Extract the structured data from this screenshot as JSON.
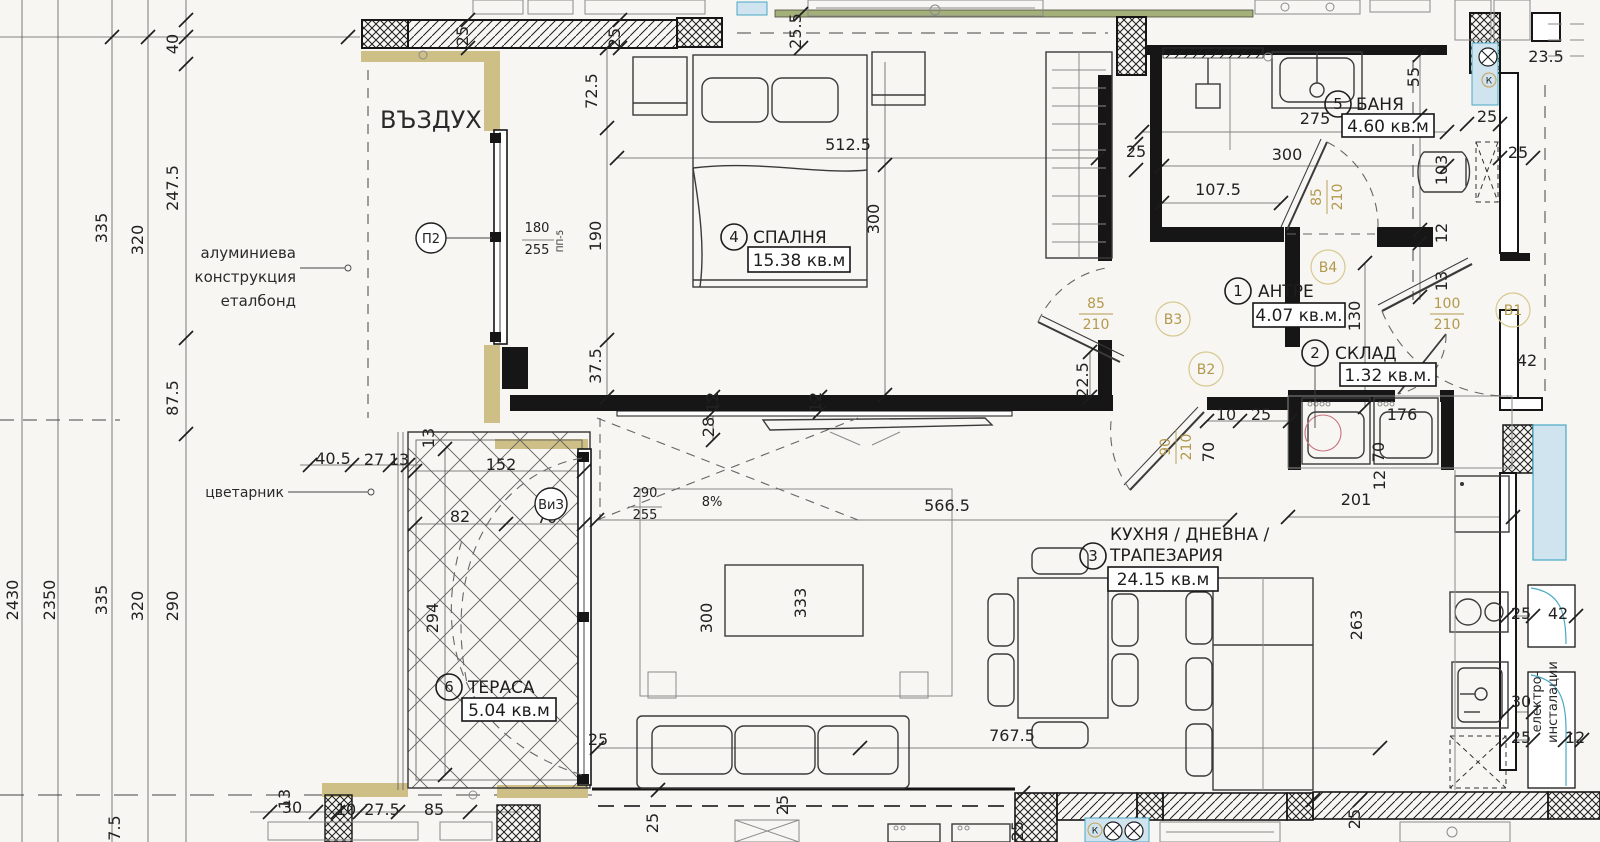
{
  "drawing_title": "апартамент — разпределение (floor plan)",
  "units_label": "кв.м",
  "colors": {
    "paper": "#f7f6f2",
    "ink": "#1d1d1d",
    "insulation_olive": "#cdbf85",
    "facade_green": "#a4b07a",
    "shaft_cyan_fill": "#cfe4ef",
    "shaft_cyan_stroke": "#49a8c4",
    "door_tag_olive": "#b3984d",
    "accent_red": "#c9707c"
  },
  "rooms": [
    {
      "num": "1",
      "name": "АНТРЕ",
      "area": "4.07 кв.м."
    },
    {
      "num": "2",
      "name": "СКЛАД",
      "area": "1.32 кв.м."
    },
    {
      "num": "3",
      "name": "КУХНЯ / ДНЕВНА /",
      "name2": "ТРАПЕЗАРИЯ",
      "area": "24.15 кв.м"
    },
    {
      "num": "4",
      "name": "СПАЛНЯ",
      "area": "15.38 кв.м"
    },
    {
      "num": "5",
      "name": "БАНЯ",
      "area": "4.60 кв.м"
    },
    {
      "num": "6",
      "name": "ТЕРАСА",
      "area": "5.04 кв.м"
    }
  ],
  "notes": [
    {
      "t": "ВЪЗДУХ",
      "x": 380,
      "y": 128,
      "r": 0,
      "s": 24,
      "a": "start"
    },
    {
      "t": "алуминиева",
      "x": 296,
      "y": 258,
      "r": 0,
      "s": 15,
      "a": "end"
    },
    {
      "t": "конструкция",
      "x": 296,
      "y": 282,
      "r": 0,
      "s": 15,
      "a": "end"
    },
    {
      "t": "еталбонд",
      "x": 296,
      "y": 306,
      "r": 0,
      "s": 15,
      "a": "end"
    },
    {
      "t": "цветарник",
      "x": 284,
      "y": 497,
      "r": 0,
      "s": 14,
      "a": "end"
    },
    {
      "t": "електро-",
      "x": 1541,
      "y": 702,
      "r": -90,
      "s": 13,
      "a": "middle"
    },
    {
      "t": "инсталации",
      "x": 1557,
      "y": 702,
      "r": -90,
      "s": 13,
      "a": "middle"
    },
    {
      "t": "ПП-5",
      "x": 563,
      "y": 241,
      "r": -90,
      "s": 9,
      "a": "middle"
    }
  ],
  "dim_labels": [
    {
      "t": "40",
      "x": 178,
      "y": 44,
      "r": -90
    },
    {
      "t": "247.5",
      "x": 178,
      "y": 188,
      "r": -90
    },
    {
      "t": "335",
      "x": 107,
      "y": 228,
      "r": -90
    },
    {
      "t": "320",
      "x": 143,
      "y": 240,
      "r": -90
    },
    {
      "t": "87.5",
      "x": 178,
      "y": 398,
      "r": -90
    },
    {
      "t": "2430",
      "x": 18,
      "y": 600,
      "r": -90
    },
    {
      "t": "2350",
      "x": 55,
      "y": 600,
      "r": -90
    },
    {
      "t": "335",
      "x": 107,
      "y": 600,
      "r": -90
    },
    {
      "t": "320",
      "x": 143,
      "y": 606,
      "r": -90
    },
    {
      "t": "290",
      "x": 178,
      "y": 606,
      "r": -90
    },
    {
      "t": "7.5",
      "x": 120,
      "y": 828,
      "r": -90
    },
    {
      "t": "40.5",
      "x": 333,
      "y": 464,
      "r": 0
    },
    {
      "t": "27",
      "x": 374,
      "y": 465,
      "r": 0
    },
    {
      "t": "13",
      "x": 399,
      "y": 465,
      "r": 0
    },
    {
      "t": "30",
      "x": 292,
      "y": 813,
      "r": 0
    },
    {
      "t": "10",
      "x": 346,
      "y": 815,
      "r": 0
    },
    {
      "t": "27.5",
      "x": 382,
      "y": 815,
      "r": 0
    },
    {
      "t": "85",
      "x": 434,
      "y": 815,
      "r": 0
    },
    {
      "t": "13",
      "x": 290,
      "y": 799,
      "r": -90
    },
    {
      "t": "13",
      "x": 434,
      "y": 438,
      "r": -90
    },
    {
      "t": "25",
      "x": 468,
      "y": 36,
      "r": -90
    },
    {
      "t": "25",
      "x": 620,
      "y": 38,
      "r": -90
    },
    {
      "t": "25.5",
      "x": 801,
      "y": 31,
      "r": -90
    },
    {
      "t": "72.5",
      "x": 597,
      "y": 91,
      "r": -90
    },
    {
      "t": "512.5",
      "x": 848,
      "y": 150,
      "r": 0
    },
    {
      "t": "190",
      "x": 601,
      "y": 236,
      "r": -90
    },
    {
      "t": "300",
      "x": 879,
      "y": 219,
      "r": -90
    },
    {
      "t": "37.5",
      "x": 601,
      "y": 366,
      "r": -90
    },
    {
      "t": "180",
      "x": 537,
      "y": 232,
      "r": 0,
      "s": "small"
    },
    {
      "t": "255",
      "x": 537,
      "y": 254,
      "r": 0,
      "s": "small"
    },
    {
      "t": "25",
      "x": 1136,
      "y": 157,
      "r": 0
    },
    {
      "t": "275",
      "x": 1315,
      "y": 124,
      "r": 0
    },
    {
      "t": "300",
      "x": 1287,
      "y": 160,
      "r": 0
    },
    {
      "t": "107.5",
      "x": 1218,
      "y": 195,
      "r": 0
    },
    {
      "t": "55",
      "x": 1419,
      "y": 77,
      "r": -90
    },
    {
      "t": "23.5",
      "x": 1546,
      "y": 62,
      "r": 0
    },
    {
      "t": "25",
      "x": 1487,
      "y": 122,
      "r": 0
    },
    {
      "t": "25",
      "x": 1518,
      "y": 158,
      "r": 0
    },
    {
      "t": "103",
      "x": 1447,
      "y": 170,
      "r": -90
    },
    {
      "t": "12",
      "x": 1447,
      "y": 233,
      "r": -90
    },
    {
      "t": "13",
      "x": 1447,
      "y": 281,
      "r": -90
    },
    {
      "t": "130",
      "x": 1360,
      "y": 316,
      "r": -90
    },
    {
      "t": "42",
      "x": 1527,
      "y": 366,
      "r": 0
    },
    {
      "t": "10",
      "x": 1226,
      "y": 420,
      "r": 0
    },
    {
      "t": "25",
      "x": 1261,
      "y": 420,
      "r": 0
    },
    {
      "t": "70",
      "x": 1214,
      "y": 452,
      "r": -90
    },
    {
      "t": "176",
      "x": 1402,
      "y": 420,
      "r": 0
    },
    {
      "t": "70",
      "x": 1384,
      "y": 452,
      "r": -90
    },
    {
      "t": "12",
      "x": 1385,
      "y": 480,
      "r": -90
    },
    {
      "t": "201",
      "x": 1356,
      "y": 505,
      "r": 0
    },
    {
      "t": "263",
      "x": 1362,
      "y": 625,
      "r": -90
    },
    {
      "t": "25",
      "x": 1521,
      "y": 619,
      "r": 0
    },
    {
      "t": "42",
      "x": 1558,
      "y": 619,
      "r": 0
    },
    {
      "t": "30",
      "x": 1521,
      "y": 707,
      "r": 0
    },
    {
      "t": "25",
      "x": 1521,
      "y": 743,
      "r": 0
    },
    {
      "t": "12",
      "x": 1575,
      "y": 743,
      "r": 0
    },
    {
      "t": "566.5",
      "x": 947,
      "y": 511,
      "r": 0
    },
    {
      "t": "8%",
      "x": 712,
      "y": 506,
      "r": 0,
      "s": "small"
    },
    {
      "t": "290",
      "x": 645,
      "y": 497,
      "r": 0,
      "s": "small"
    },
    {
      "t": "255",
      "x": 645,
      "y": 519,
      "r": 0,
      "s": "small"
    },
    {
      "t": "28",
      "x": 714,
      "y": 427,
      "r": -90
    },
    {
      "t": "12",
      "x": 718,
      "y": 402,
      "r": -90
    },
    {
      "t": "12",
      "x": 821,
      "y": 402,
      "r": -90
    },
    {
      "t": "300",
      "x": 712,
      "y": 618,
      "r": -90
    },
    {
      "t": "333",
      "x": 806,
      "y": 603,
      "r": -90
    },
    {
      "t": "767.5",
      "x": 1012,
      "y": 741,
      "r": 0
    },
    {
      "t": "25",
      "x": 598,
      "y": 745,
      "r": 0
    },
    {
      "t": "25",
      "x": 788,
      "y": 805,
      "r": -90
    },
    {
      "t": "25",
      "x": 1360,
      "y": 819,
      "r": -90
    },
    {
      "t": "25",
      "x": 658,
      "y": 823,
      "r": -90
    },
    {
      "t": "25",
      "x": 1023,
      "y": 831,
      "r": -90
    },
    {
      "t": "152",
      "x": 501,
      "y": 470,
      "r": 0
    },
    {
      "t": "82",
      "x": 460,
      "y": 522,
      "r": 0
    },
    {
      "t": "70",
      "x": 547,
      "y": 523,
      "r": 0
    },
    {
      "t": "294",
      "x": 438,
      "y": 618,
      "r": -90
    },
    {
      "t": "22.5",
      "x": 1088,
      "y": 380,
      "r": -90
    }
  ],
  "door_tags": [
    {
      "a": "85",
      "b": "210",
      "x": 1096,
      "y": 314,
      "r": 0
    },
    {
      "a": "85",
      "b": "210",
      "x": 1327,
      "y": 197,
      "r": -90
    },
    {
      "a": "90",
      "b": "210",
      "x": 1176,
      "y": 447,
      "r": -90
    },
    {
      "a": "100",
      "b": "210",
      "x": 1447,
      "y": 314,
      "r": 0
    }
  ],
  "tag_circles": [
    {
      "t": "В1",
      "x": 1513,
      "y": 310
    },
    {
      "t": "В2",
      "x": 1206,
      "y": 369
    },
    {
      "t": "В3",
      "x": 1173,
      "y": 319
    },
    {
      "t": "В4",
      "x": 1328,
      "y": 267
    }
  ],
  "axis_marks": [
    {
      "t": "П2",
      "x": 431,
      "y": 238,
      "rad": 15
    },
    {
      "t": "ВиЗ",
      "x": 551,
      "y": 504,
      "rad": 16
    }
  ],
  "window_size_fractions": [
    {
      "a": "180",
      "b": "255",
      "note": "window ПП-5"
    },
    {
      "a": "290",
      "b": "255",
      "note": "terrace window ВиЗ"
    }
  ],
  "symbols": [
    {
      "t": "К",
      "kind": "tan-circle",
      "x": 1489,
      "y": 80
    },
    {
      "t": "К",
      "kind": "tan-circle",
      "x": 1095,
      "y": 830
    },
    {
      "kind": "fan-circle",
      "x": 1488,
      "y": 57
    },
    {
      "kind": "fan-circle",
      "x": 1113,
      "y": 831
    },
    {
      "kind": "fan-circle",
      "x": 1134,
      "y": 831
    }
  ]
}
